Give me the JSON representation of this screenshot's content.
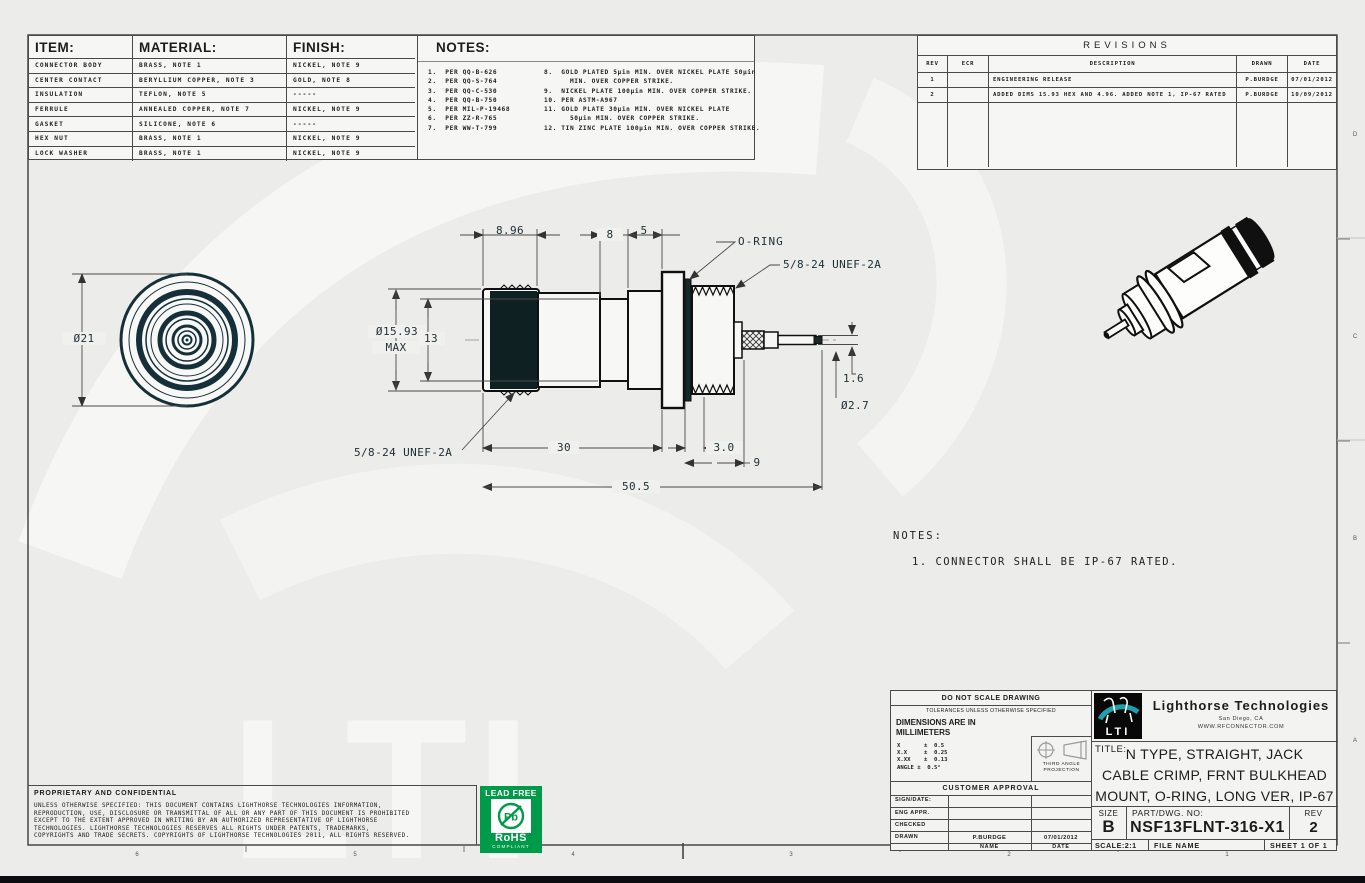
{
  "sheet": {
    "bg": "#ececea",
    "zones_bottom": [
      "6",
      "5",
      "4",
      "3",
      "2",
      "1"
    ],
    "zones_right": [
      "D",
      "C",
      "B",
      "A"
    ]
  },
  "materials_table": {
    "headers": [
      "ITEM:",
      "MATERIAL:",
      "FINISH:"
    ],
    "rows": [
      {
        "item": "CONNECTOR BODY",
        "material": "BRASS, NOTE 1",
        "finish": "NICKEL, NOTE 9"
      },
      {
        "item": "CENTER CONTACT",
        "material": "BERYLLIUM COPPER, NOTE 3",
        "finish": "GOLD, NOTE 8"
      },
      {
        "item": "INSULATION",
        "material": "TEFLON, NOTE 5",
        "finish": "-----"
      },
      {
        "item": "FERRULE",
        "material": "ANNEALED COPPER, NOTE 7",
        "finish": "NICKEL, NOTE 9"
      },
      {
        "item": "GASKET",
        "material": "SILICONE, NOTE 6",
        "finish": "-----"
      },
      {
        "item": "HEX NUT",
        "material": "BRASS, NOTE 1",
        "finish": "NICKEL, NOTE 9"
      },
      {
        "item": "LOCK WASHER",
        "material": "BRASS, NOTE 1",
        "finish": "NICKEL, NOTE 9"
      }
    ]
  },
  "top_notes": {
    "title": "NOTES:",
    "left_column": "1.  PER QQ-B-626\n2.  PER QQ-S-764\n3.  PER QQ-C-530\n4.  PER QQ-B-750\n5.  PER MIL-P-19468\n6.  PER ZZ-R-765\n7.  PER WW-T-799",
    "right_column": "8.  GOLD PLATED 5µin MIN. OVER NICKEL PLATE 50µin\n      MIN. OVER COPPER STRIKE.\n9.  NICKEL PLATE 100µin MIN. OVER COPPER STRIKE.\n10. PER ASTM-A967\n11. GOLD PLATE 30µin MIN. OVER NICKEL PLATE\n      50µin MIN. OVER COPPER STRIKE.\n12. TIN ZINC PLATE 100µin MIN. OVER COPPER STRIKE."
  },
  "revisions": {
    "title": "REVISIONS",
    "headers": [
      "REV",
      "ECR",
      "DESCRIPTION",
      "DRAWN",
      "DATE"
    ],
    "rows": [
      {
        "rev": "1",
        "ecr": "",
        "description": "ENGINEERING RELEASE",
        "drawn": "P.BURDGE",
        "date": "07/01/2012"
      },
      {
        "rev": "2",
        "ecr": "",
        "description": "ADDED DIMS 15.93 HEX AND 4.96. ADDED NOTE 1, IP-67 RATED",
        "drawn": "P.BURDGE",
        "date": "10/09/2012"
      }
    ]
  },
  "drawing": {
    "front_dia": "Ø21",
    "dim_896": "8.96",
    "dim_8": "8",
    "dim_5": "5",
    "oring_label": "O-RING",
    "thread_label_top": "5/8-24 UNEF-2A",
    "dia_max_line1": "Ø15.93",
    "dia_max_line2": "MAX",
    "dim_13": "13",
    "dim_16": "1.6",
    "dia_27": "Ø2.7",
    "thread_label_bottom": "5/8-24 UNEF-2A",
    "dim_30": "30",
    "dim_3_0": "3.0",
    "dim_9": "9",
    "dim_505": "50.5"
  },
  "main_notes": {
    "title": "NOTES:",
    "note_1": "1.  CONNECTOR SHALL BE IP-67 RATED."
  },
  "proprietary": {
    "title": "PROPRIETARY AND CONFIDENTIAL",
    "body": "UNLESS OTHERWISE SPECIFIED: THIS DOCUMENT CONTAINS LIGHTHORSE TECHNOLOGIES INFORMATION,\nREPRODUCTION, USE, DISCLOSURE OR TRANSMITTAL OF ALL OR ANY PART OF THIS DOCUMENT IS PROHIBITED\nEXCEPT TO THE EXTENT APPROVED IN WRITING BY AN AUTHORIZED REPRESENTATIVE OF LIGHTHORSE\nTECHNOLOGIES. LIGHTHORSE TECHNOLOGIES RESERVES ALL RIGHTS UNDER PATENTS, TRADEMARKS,\nCOPYRIGHTS AND TRADE SECRETS. COPYRIGHTS OF LIGHTHORSE TECHNOLOGIES 2011, ALL RIGHTS RESERVED."
  },
  "rohs": {
    "lead_free": "LEAD FREE",
    "pb": "Pb",
    "rohs": "RoHS",
    "compliant": "COMPLIANT",
    "green": "#009b48"
  },
  "title_block": {
    "do_not_scale": "DO NOT SCALE DRAWING",
    "tolerances_header": "TOLERANCES UNLESS OTHERWISE SPECIFIED",
    "dimensions_note": "DIMENSIONS ARE IN\nMILLIMETERS",
    "tolerances": "X       ±  0.5\nX.X     ±  0.25\nX.XX    ±  0.13\nANGLE ±  0.5°",
    "third_angle": "THIRD ANGLE\nPROJECTION",
    "customer_approval": "CUSTOMER APPROVAL",
    "sign_date": "SIGN/DATE:",
    "eng_appr": "ENG APPR.",
    "checked": "CHECKED",
    "drawn": "DRAWN",
    "drawn_name": "P.BURDGE",
    "drawn_date": "07/01/2012",
    "name_label": "NAME",
    "date_label": "DATE",
    "company": "Lighthorse Technologies",
    "location": "San Diego, CA",
    "website": "WWW.RFCONNECTOR.COM",
    "logo_text": "LTI",
    "title_label": "TITLE:",
    "title_line1": "N TYPE, STRAIGHT, JACK",
    "title_line2": "CABLE CRIMP, FRNT BULKHEAD",
    "title_line3": "MOUNT, O-RING, LONG VER, IP-67",
    "size_label": "SIZE",
    "size": "B",
    "part_label": "PART/DWG.  NO:",
    "part_number": "NSF13FLNT-316-X1",
    "rev_label": "REV",
    "rev": "2",
    "scale": "SCALE:2:1",
    "file_label": "FILE NAME",
    "sheet_label": "SHEET 1 OF 1"
  }
}
